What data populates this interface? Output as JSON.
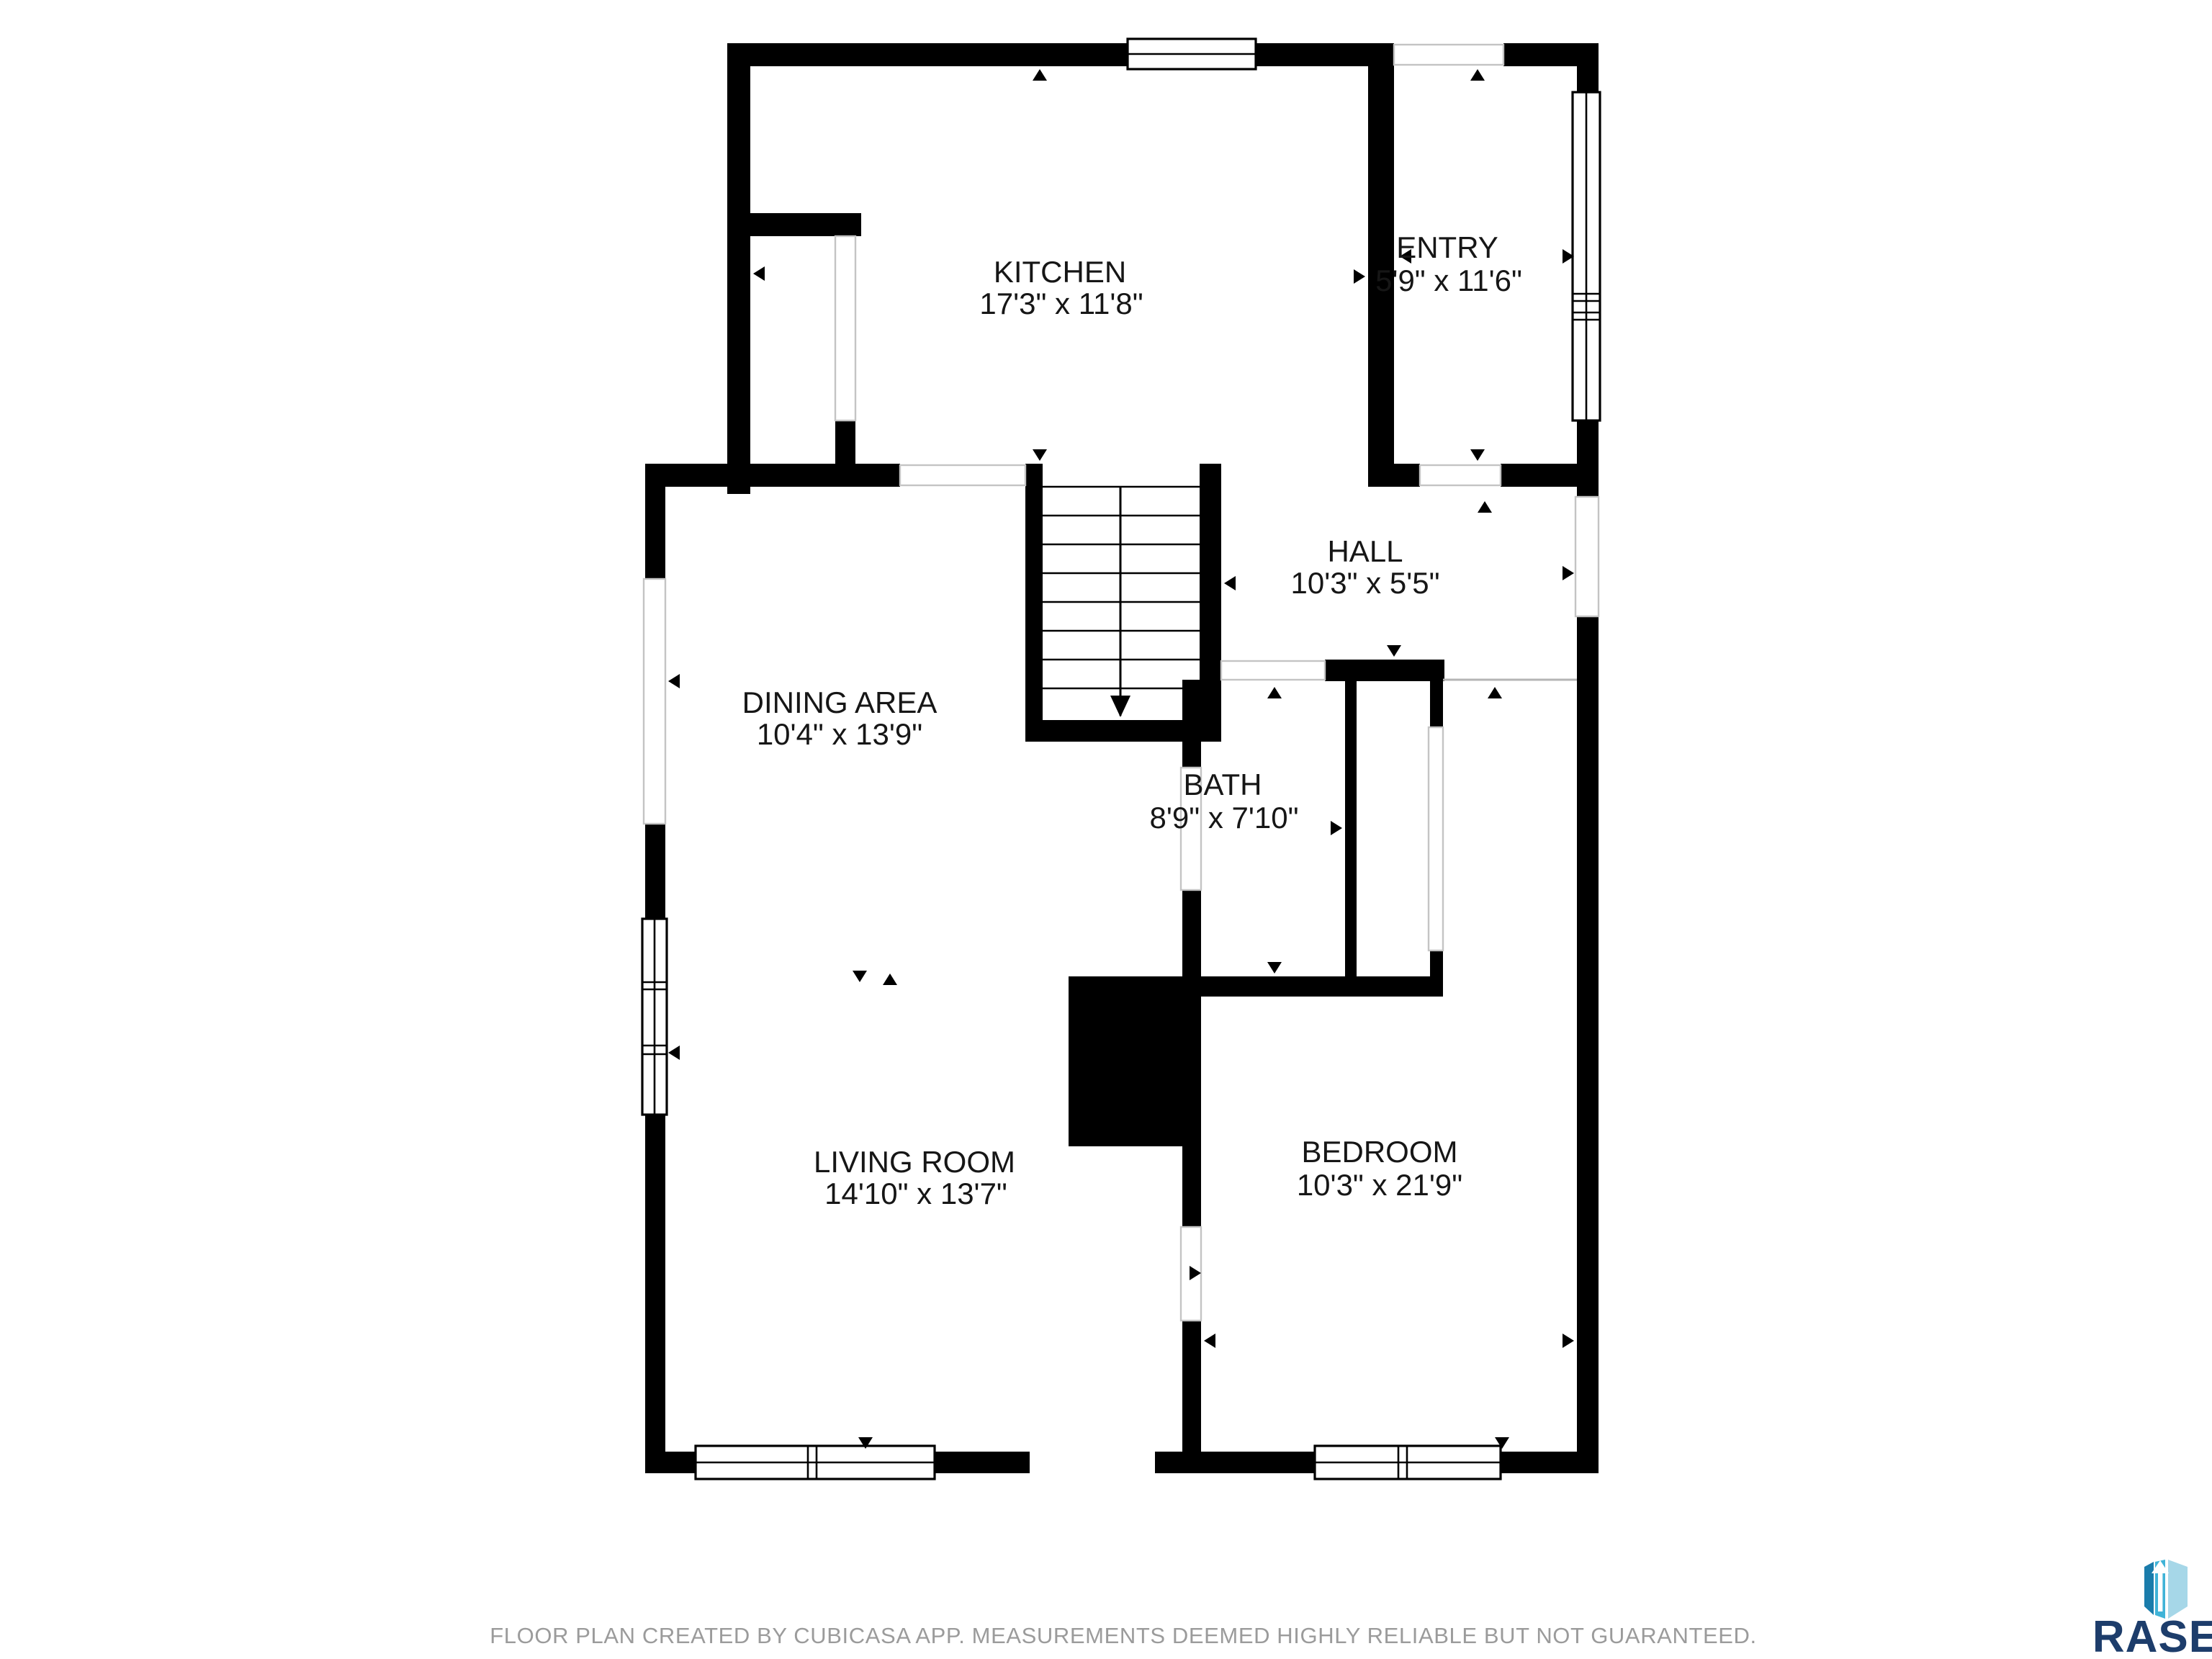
{
  "page": {
    "background": "#ffffff",
    "wall_color": "#000000"
  },
  "floor_plan": {
    "rooms": [
      {
        "id": "kitchen",
        "name": "KITCHEN",
        "dimensions": "17'3\" x 11'8\""
      },
      {
        "id": "entry",
        "name": "ENTRY",
        "dimensions": "5'9\" x 11'6\""
      },
      {
        "id": "hall",
        "name": "HALL",
        "dimensions": "10'3\" x 5'5\""
      },
      {
        "id": "dining",
        "name": "DINING AREA",
        "dimensions": "10'4\" x 13'9\""
      },
      {
        "id": "bath",
        "name": "BATH",
        "dimensions": "8'9\" x 7'10\""
      },
      {
        "id": "living",
        "name": "LIVING ROOM",
        "dimensions": "14'10\" x 13'7\""
      },
      {
        "id": "bedroom",
        "name": "BEDROOM",
        "dimensions": "10'3\" x 21'9\""
      }
    ]
  },
  "footer": {
    "disclaimer": "FLOOR PLAN CREATED BY CUBICASA APP. MEASUREMENTS DEEMED HIGHLY RELIABLE BUT NOT GUARANTEED.",
    "color": "#9b9b9b"
  },
  "branding": {
    "name": "RASE",
    "text_color": "#1d3d6b",
    "icon": {
      "name": "rase-box-arrow-icon",
      "colors": {
        "left": "#1a7cab",
        "middle": "#3fb3d7",
        "right": "#a6d7e8",
        "arrow": "#ffffff"
      }
    }
  }
}
